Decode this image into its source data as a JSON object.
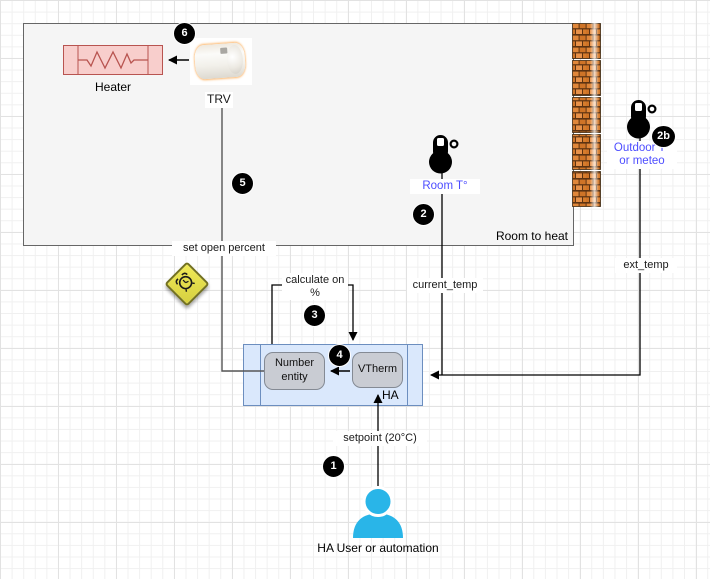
{
  "diagram": {
    "room": {
      "label": "Room to heat"
    },
    "heater": {
      "label": "Heater"
    },
    "trv": {
      "label": "TRV"
    },
    "sensors": {
      "room_label": "Room T°",
      "outdoor_label": "Outdoor T° or meteo"
    },
    "connectors": {
      "set_open_percent": "set open percent",
      "calculate": "calculate on %",
      "current_temp": "current_temp",
      "ext_temp": "ext_temp",
      "setpoint": "setpoint (20°C)"
    },
    "ha": {
      "label": "HA",
      "number_entity": "Number entity",
      "vtherm": "VTherm"
    },
    "user": {
      "label": "HA User or automation"
    },
    "badges": {
      "step1": "1",
      "step2": "2",
      "step2b": "2b",
      "step3": "3",
      "step4": "4",
      "step5": "5",
      "step6": "6"
    },
    "colors": {
      "sensor_label_blue": "#4d4dff",
      "ha_box_fill": "#dae8fc",
      "ha_box_border": "#6c8ebf",
      "heater_fill": "#f8cecc",
      "heater_border": "#b85450",
      "entity_fill": "#c9ccd3",
      "person_blue": "#29b5e8",
      "badge_black": "#000000",
      "brick_orange": "#d97c2e",
      "warning_yellow": "#e8e24a",
      "room_fill": "#f5f5f5"
    }
  }
}
